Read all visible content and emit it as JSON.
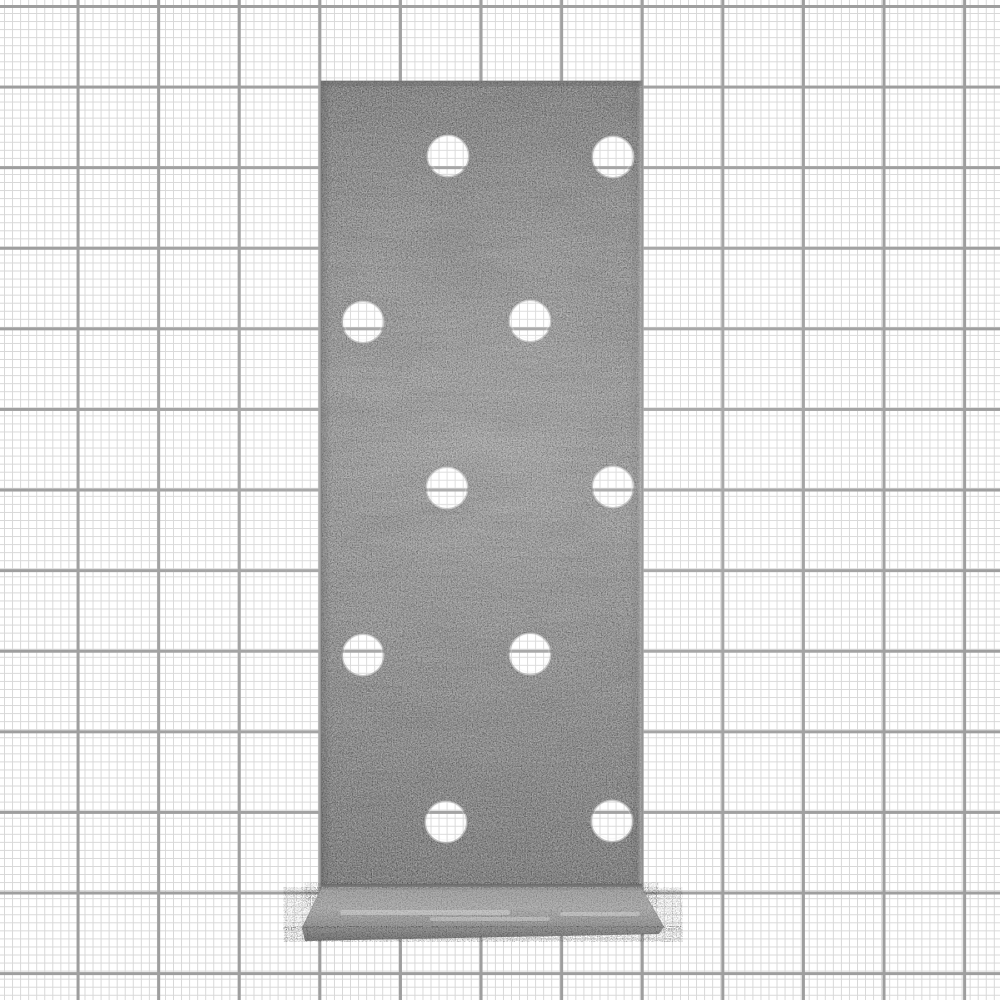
{
  "scene": {
    "description": "Product photograph of a galvanized steel angle bracket (perforated mounting plate with bottom flange) lying on white graph paper",
    "background": {
      "paper_color": "#ffffff",
      "minor_line_color": "#d7d7d7",
      "major_line_color": "#9e9e9e",
      "minor_spacing_px": 8.06,
      "major_spacing_px": 80.6,
      "minor_line_width_px": 1,
      "major_line_width_px": 3
    }
  },
  "bracket": {
    "object": "perforated-steel-angle-bracket",
    "material": "galvanized-steel",
    "base_color": "#9b9b9b",
    "dark_speckle_color": "#3c3c3c",
    "light_speckle_color": "#ffffff",
    "edge_line_color": "#6a6a6a",
    "face": {
      "x": 321,
      "y": 81,
      "width": 321,
      "height": 809
    },
    "hole_radius_px": 21.5,
    "hole_count": 10,
    "holes": [
      {
        "cx": 448,
        "cy": 156
      },
      {
        "cx": 613,
        "cy": 157
      },
      {
        "cx": 363,
        "cy": 322
      },
      {
        "cx": 530,
        "cy": 321
      },
      {
        "cx": 447,
        "cy": 488
      },
      {
        "cx": 613,
        "cy": 487
      },
      {
        "cx": 363,
        "cy": 655
      },
      {
        "cx": 530,
        "cy": 654
      },
      {
        "cx": 446,
        "cy": 822
      },
      {
        "cx": 612,
        "cy": 821
      }
    ],
    "bend": {
      "x": 321,
      "y": 884,
      "width": 321,
      "height": 21
    },
    "flange_top_points": "321,889 642,889 664,927 302,928",
    "flange_lip_points": "302,928 664,927 659,934 305,941",
    "flange_streaks": [
      {
        "x": 340,
        "y": 910,
        "width": 170,
        "height": 5
      },
      {
        "x": 430,
        "y": 917,
        "width": 120,
        "height": 4
      },
      {
        "x": 560,
        "y": 912,
        "width": 80,
        "height": 4
      }
    ]
  }
}
